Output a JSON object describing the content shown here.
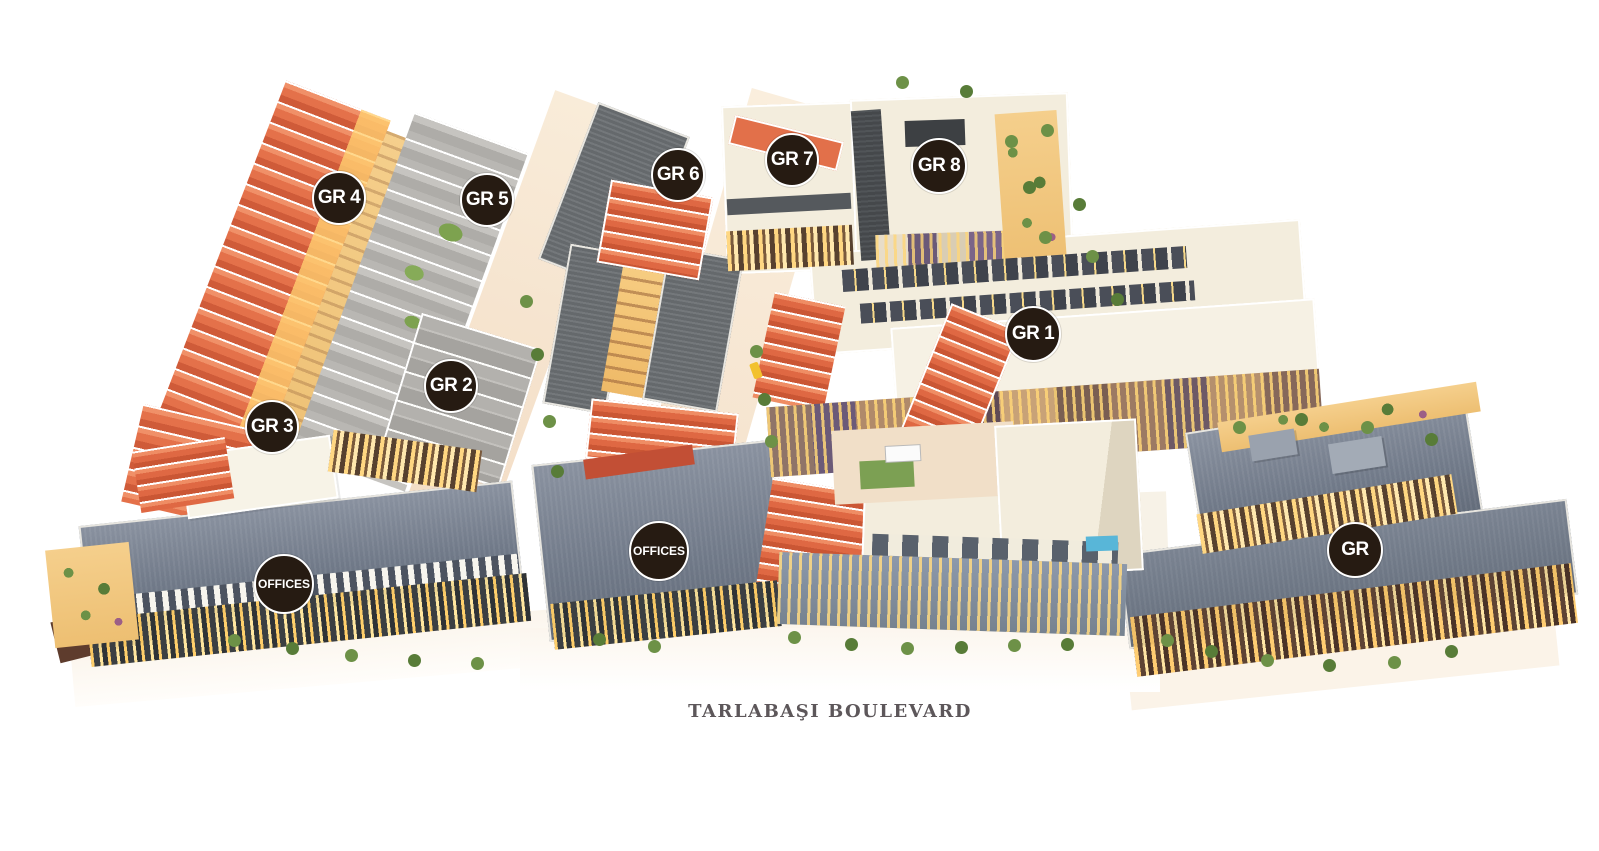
{
  "street": {
    "label": "TARLABAŞI BOULEVARD"
  },
  "badges": {
    "gr1": {
      "label": "GR 1"
    },
    "gr2": {
      "label": "GR 2"
    },
    "gr3": {
      "label": "GR 3"
    },
    "gr4": {
      "label": "GR 4"
    },
    "gr5": {
      "label": "GR 5"
    },
    "gr6": {
      "label": "GR 6"
    },
    "gr7": {
      "label": "GR 7"
    },
    "gr8": {
      "label": "GR 8"
    },
    "gr_unnumbered": {
      "label": "GR"
    },
    "offices_west": {
      "label": "OFFICES"
    },
    "offices_center": {
      "label": "OFFICES"
    }
  },
  "colors": {
    "background": "#ffffff",
    "badge_background": "#261b12",
    "badge_ring": "#ffffff",
    "badge_text": "#ffffff",
    "roof_terracotta": "#e06c46",
    "roof_slate": "#76808e",
    "roof_gray": "#b3b1ad",
    "roof_cream": "#f3eddd",
    "window_glow": "#ffd782",
    "tree_green": "#6d9147",
    "street_label_text": "#5d575a"
  }
}
